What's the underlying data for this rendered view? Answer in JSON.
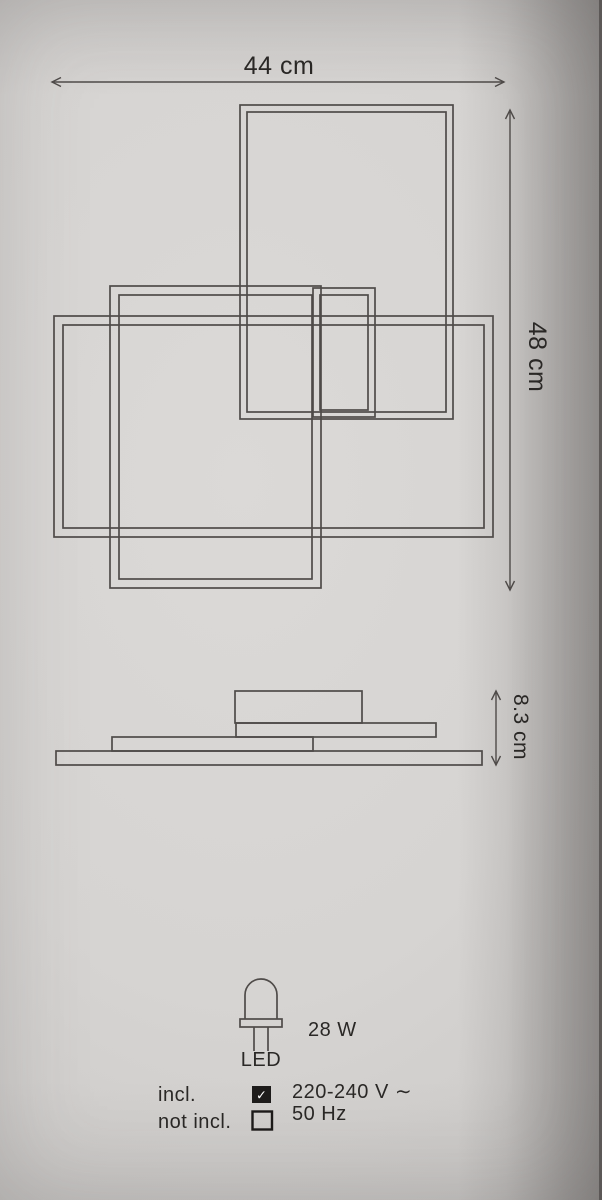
{
  "product_diagram": {
    "front_view": {
      "width_dimension": "44 cm",
      "height_dimension": "48 cm"
    },
    "side_view": {
      "depth_dimension": "8.3 cm"
    },
    "power": {
      "wattage": "28 W",
      "light_source": "LED"
    },
    "electrical": {
      "voltage": "220-240 V ∼",
      "frequency": "50 Hz"
    },
    "legend": {
      "included": "incl.",
      "not_included": "not incl.",
      "check_icon": "✓"
    }
  },
  "colors": {
    "paper": "#d6d4d2",
    "line": "#4f4b49",
    "text": "#2a2826",
    "checkbox_fill": "#1d1b1a",
    "check_mark": "#ffffff"
  }
}
